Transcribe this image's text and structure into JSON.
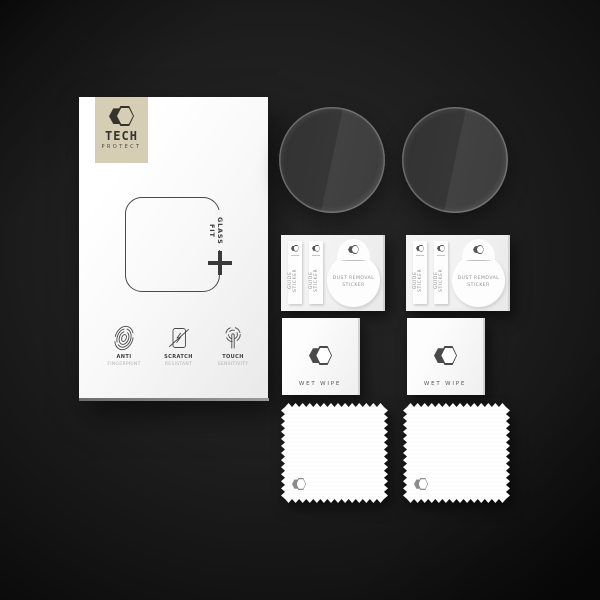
{
  "scene": {
    "description": "Tech-Protect Glass Fit watch screen protector kit on dark backdrop",
    "background_center_color": "#292929",
    "background_edge_color": "#0b0b0b"
  },
  "box": {
    "logo": {
      "brand": "TECH",
      "sub": "PROTECT",
      "panel_color": "#d6cdb5"
    },
    "fit_label": "GLASS FIT",
    "features": [
      {
        "icon": "fingerprint-icon",
        "title": "ANTI",
        "subtitle": "FINGERPRINT"
      },
      {
        "icon": "scratch-icon",
        "title": "SCRATCH",
        "subtitle": "RESISTANT"
      },
      {
        "icon": "touch-icon",
        "title": "TOUCH",
        "subtitle": "SENSITIVITY"
      }
    ]
  },
  "sticker_cards": [
    {
      "strips": [
        "GUIDE STICKER",
        "GUIDE STICKER"
      ],
      "dust_line1": "DUST REMOVAL",
      "dust_line2": "STICKER"
    },
    {
      "strips": [
        "GUIDE STICKER",
        "GUIDE STICKER"
      ],
      "dust_line1": "DUST REMOVAL",
      "dust_line2": "STICKER"
    }
  ],
  "wipe_cards": [
    {
      "label": "WET WIPE"
    },
    {
      "label": "WET WIPE"
    }
  ]
}
